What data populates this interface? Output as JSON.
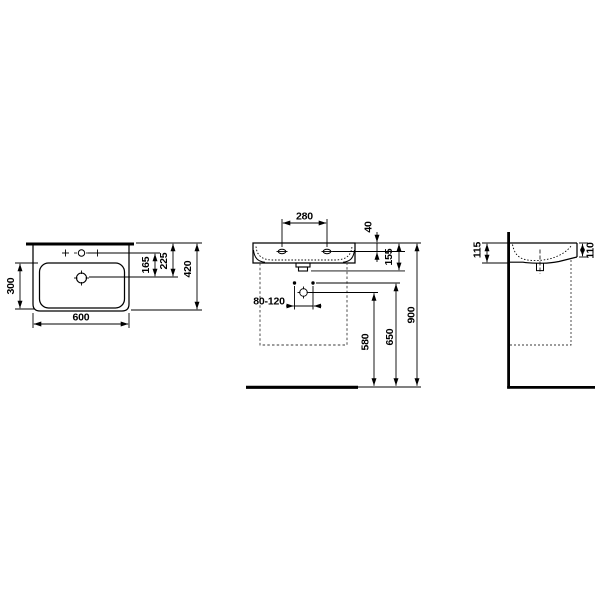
{
  "colors": {
    "line": "#000000",
    "background": "#ffffff"
  },
  "drawing": {
    "top_view": {
      "dim_bowl_depth": "300",
      "dim_width": "600",
      "dim_taphole_to_drain": "165",
      "dim_back_to_drain": "225",
      "dim_depth": "420"
    },
    "front_view": {
      "dim_hole_spacing": "280",
      "dim_top_to_holes": "40",
      "dim_body_height": "155",
      "dim_fixing_range": "80-120",
      "dim_floor_to_drain": "580",
      "dim_floor_to_fixings": "650",
      "dim_floor_to_rim": "900"
    },
    "side_view": {
      "dim_height_at_wall": "115",
      "dim_height_at_front": "110"
    }
  }
}
